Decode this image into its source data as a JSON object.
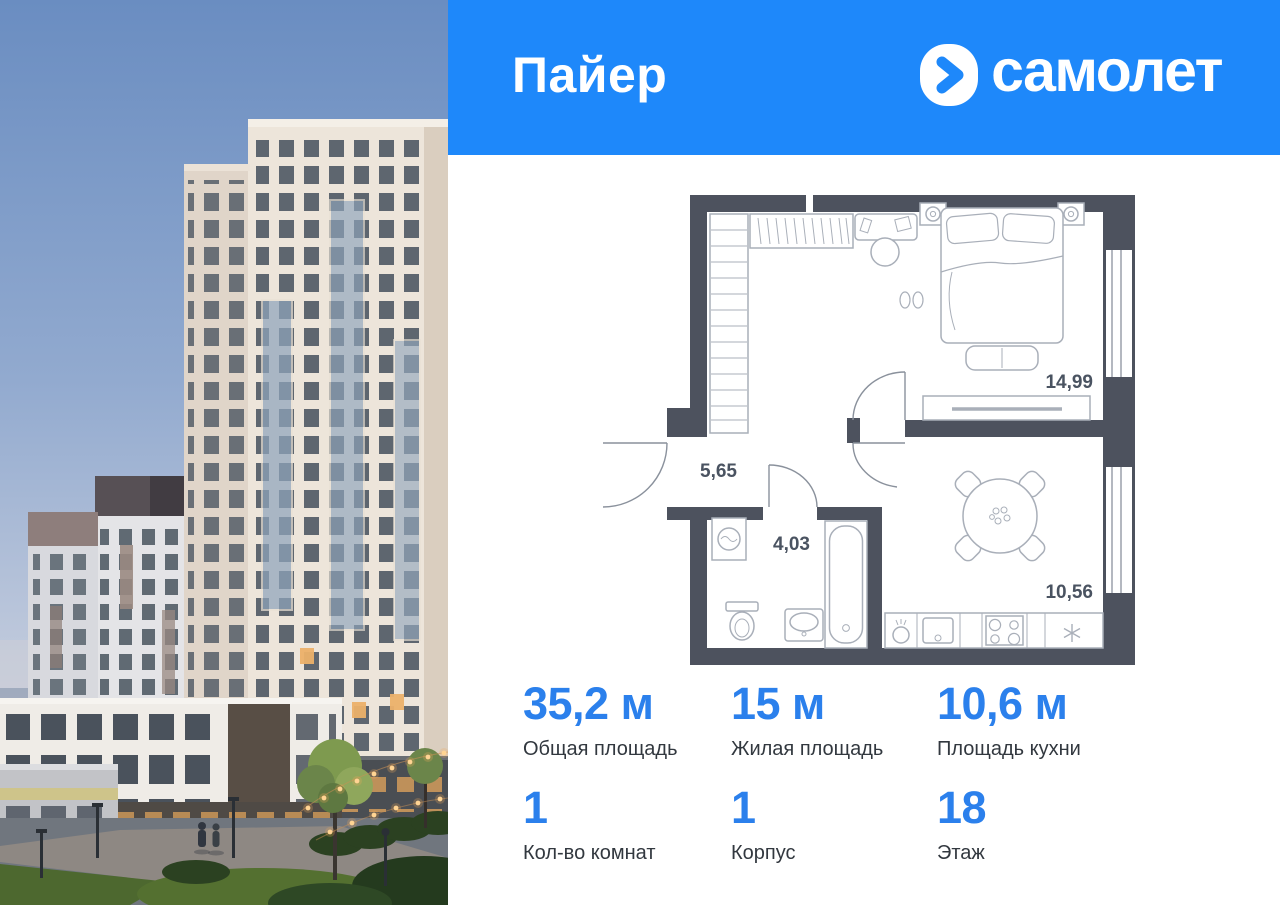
{
  "header": {
    "project_name": "Пайер",
    "brand_name": "самолет"
  },
  "floor_plan": {
    "rooms": [
      {
        "name": "living-room",
        "area": "14,99"
      },
      {
        "name": "hallway",
        "area": "5,65"
      },
      {
        "name": "bathroom",
        "area": "4,03"
      },
      {
        "name": "kitchen",
        "area": "10,56"
      }
    ]
  },
  "stats": {
    "cells": [
      {
        "value": "35,2 м",
        "label": "Общая площадь"
      },
      {
        "value": "15 м",
        "label": "Жилая площадь"
      },
      {
        "value": "10,6 м",
        "label": "Площадь кухни"
      },
      {
        "value": "1",
        "label": "Кол-во комнат"
      },
      {
        "value": "1",
        "label": "Корпус"
      },
      {
        "value": "18",
        "label": "Этаж"
      }
    ]
  },
  "colors": {
    "header_blue": "#1E88FA",
    "stat_value_blue": "#2B80EC",
    "plan_wall": "#4D525E",
    "label_dark": "#32383F"
  }
}
